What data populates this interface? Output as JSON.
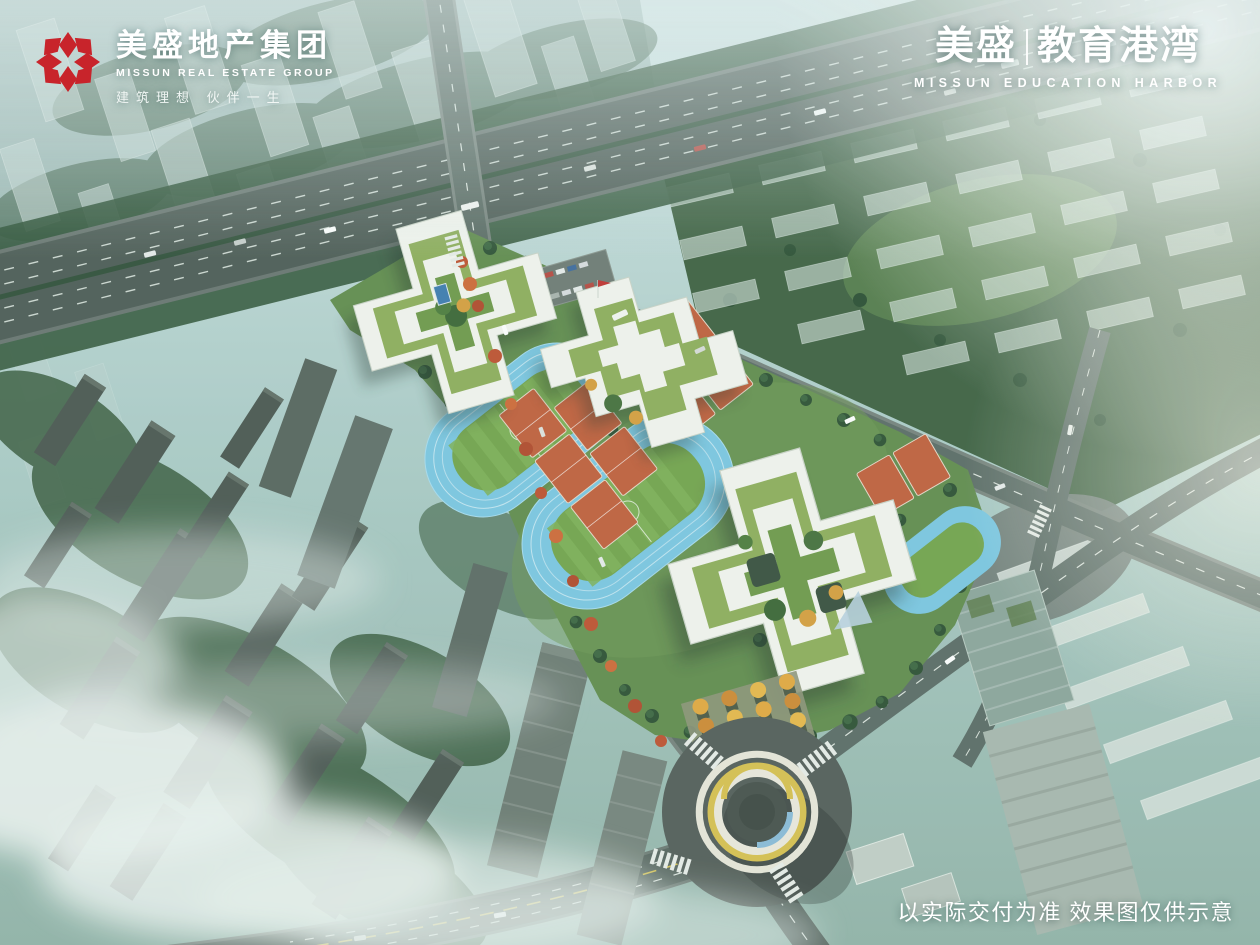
{
  "branding": {
    "logo": {
      "icon": "missun-flower-icon",
      "brand_red": "#c8242b",
      "title": "美盛地产集团",
      "subtitle": "MISSUN REAL ESTATE GROUP",
      "tagline": "建筑理想  伙伴一生"
    },
    "project": {
      "cn_left": "美盛",
      "cn_right": "教育港湾",
      "en": "MISSUN EDUCATION HARBOR"
    }
  },
  "footer": {
    "disclaimer": "以实际交付为准 效果图仅供示意"
  },
  "scene": {
    "type": "aerial-architectural-rendering",
    "subject": "school campus with cross-shaped green-roof buildings, running tracks and ring pedestrian bridge over roundabout",
    "palette": {
      "haze_teal": "#a7c6c2",
      "roof_green": "#8fae5c",
      "track_blue": "#7cc7e2",
      "court_clay": "#c2603c",
      "ring_yellow": "#d8c050",
      "road_gray": "#57655f",
      "fog_white": "#edf3f1"
    }
  }
}
